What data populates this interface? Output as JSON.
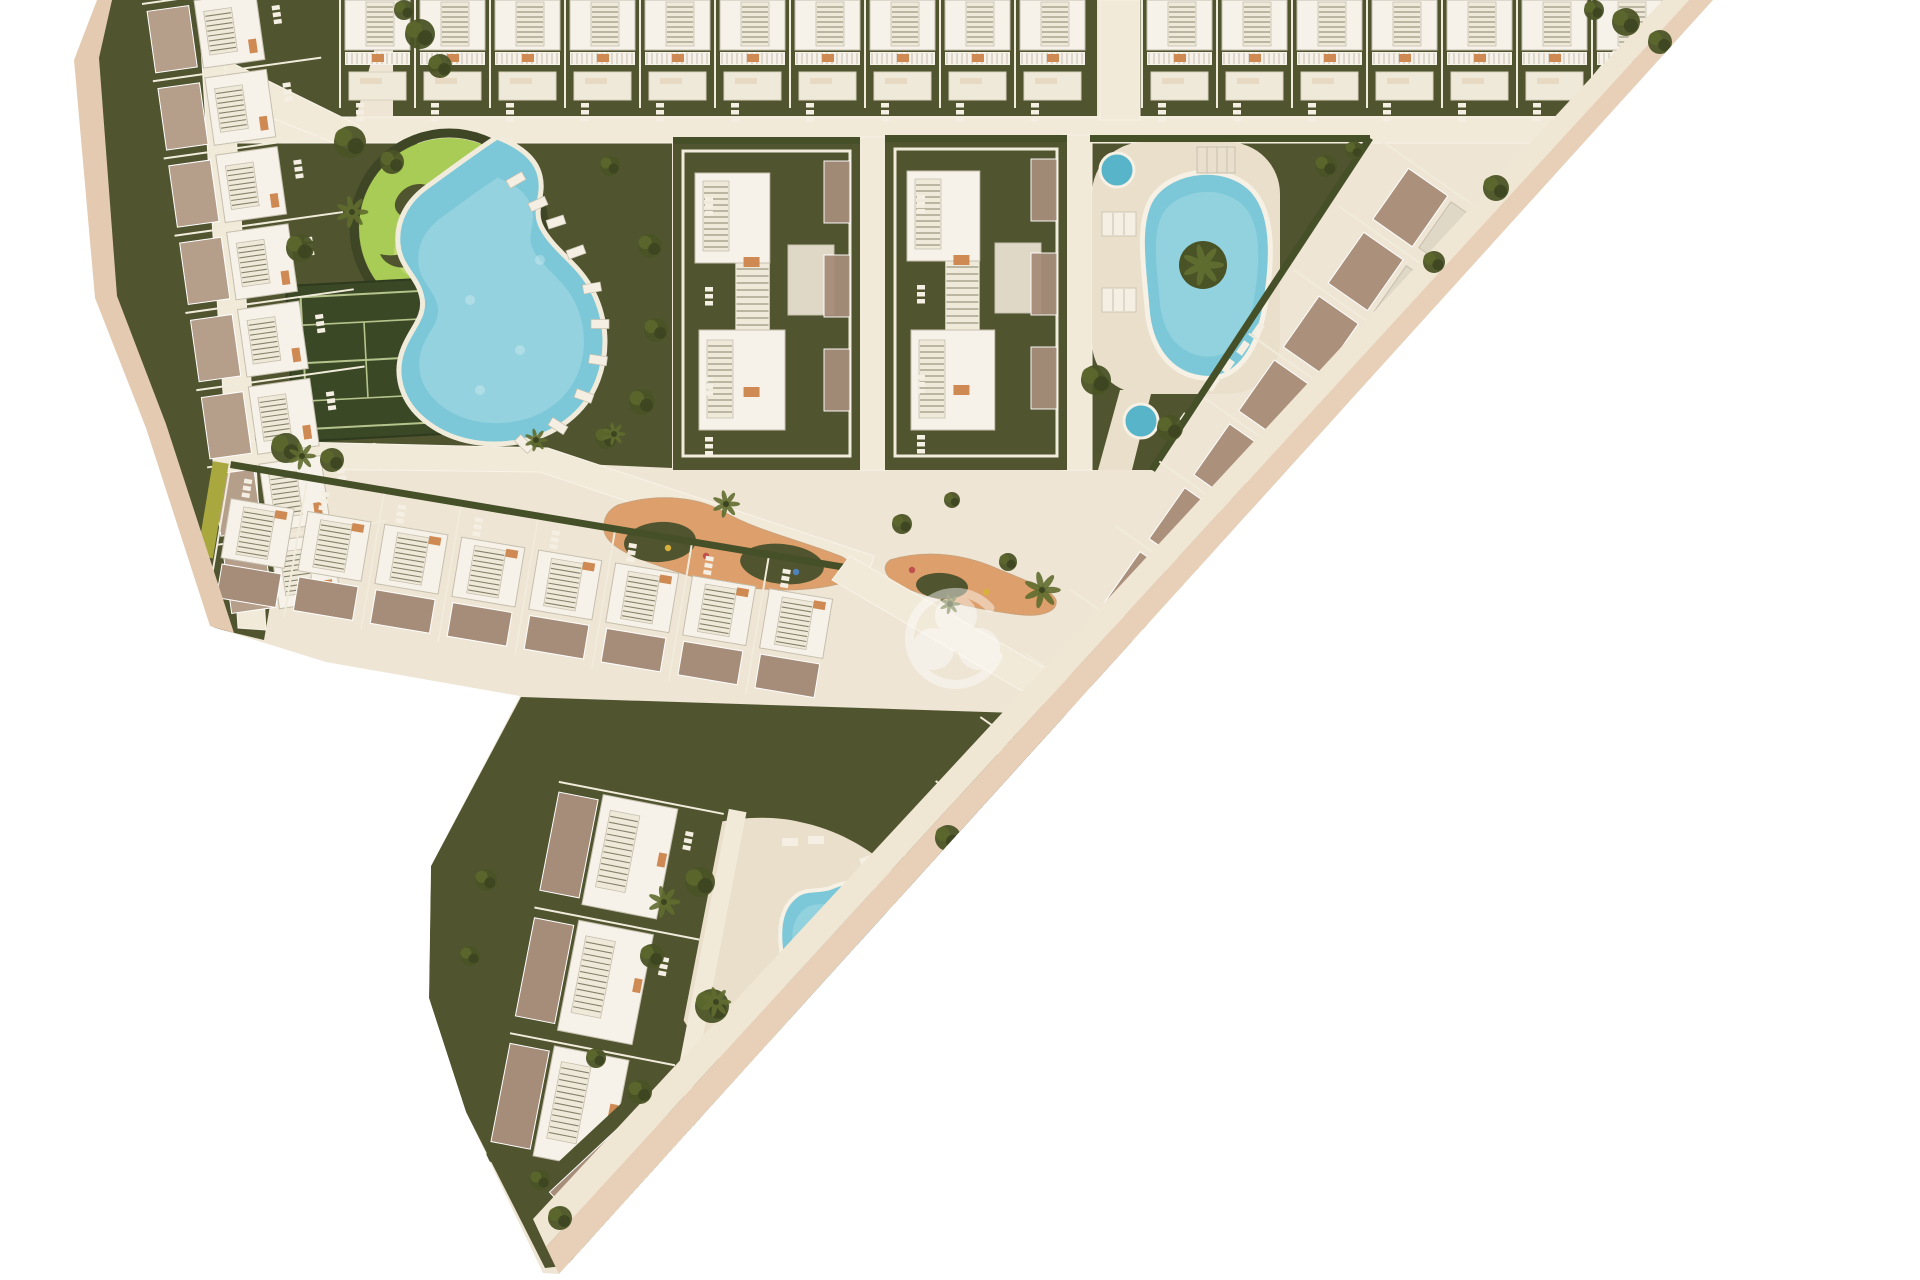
{
  "meta": {
    "type": "architectural-site-plan",
    "watermark_icon": "trefoil-logo-icon"
  },
  "colors": {
    "background": "#ffffff",
    "parcel": "#eee5d4",
    "road": "#f2ead9",
    "roadEdge": "#dfd3bd",
    "edgeOuter": "#e7cfb8",
    "edgeInner": "#f0e6d4",
    "leftBand": "#e3cab1",
    "garden": "#50542f",
    "gardenDark": "#3f4626",
    "hedge": "#454f28",
    "hedgeYellow": "#a9a83e",
    "lawn": "#a8cc55",
    "lawnLight": "#c4dc7e",
    "lawnPath": "#eae5b2",
    "court": "#3b4826",
    "courtLine": "#b6c48c",
    "water": "#7cc8d8",
    "waterLight": "#a5dbe4",
    "waterDeep": "#58b4c8",
    "deck": "#e9dfcb",
    "roofWhite": "#f6f2e9",
    "roofShade": "#e0d8c7",
    "roofEdge": "#c6bfae",
    "stairFill": "#efe9d9",
    "stairLine": "#85826b",
    "terrace": "#a68d79",
    "terraceLight": "#b59e8a",
    "accent": "#cf8a54",
    "furniture": "#f4efe2",
    "separator": "#f1ebdb",
    "tree": "#4a5326",
    "treeHi": "#5c672e",
    "treeDark": "#3c4520",
    "palm": "#5f6c2f",
    "sand": "#dd9f6b",
    "watermark": "#ffffff"
  },
  "scene": {
    "parcel": "97,0 1713,0 559,1274 543,1273 466,1112 429,998 431,866 520,696 326,662 210,626 146,428 95,298 74,60",
    "edge_bands": [
      {
        "name": "edge-band-outer-right",
        "points": "1713,0 1689,0 546,1247 559,1274",
        "color": "edgeOuter"
      },
      {
        "name": "edge-walkway-right",
        "points": "1689,0 1663,0 533,1219 546,1247",
        "color": "edgeInner"
      },
      {
        "name": "edge-band-left",
        "points": "97,0 74,60 95,298 146,428 210,626 234,633 166,424 117,296 99,58 112,0",
        "color": "leftBand"
      }
    ],
    "gardens": [
      {
        "name": "garden-top-row-west",
        "points": "393,0 1097,0 1097,116 393,116"
      },
      {
        "name": "garden-top-row-east",
        "points": "1140,0 1654,0 1560,116 1140,116"
      },
      {
        "name": "garden-left-strip",
        "points": "112,0 388,0 352,132 264,640 214,628 150,430 99,300 78,62"
      },
      {
        "name": "garden-park",
        "points": "262,133 672,133 672,468 262,450"
      },
      {
        "name": "garden-block-west",
        "points": "673,137 860,137 860,470 673,470"
      },
      {
        "name": "garden-block-east",
        "points": "885,135 1067,135 1067,470 885,470"
      },
      {
        "name": "garden-triangle",
        "points": "1090,135 1370,135 1152,470 1090,470"
      },
      {
        "name": "garden-bottom-block",
        "points": "431,866 521,697 1110,716 1135,740 563,1266 545,1268 466,1112 429,998"
      }
    ],
    "roads": [
      {
        "name": "road-top-horizontal",
        "points": "213,117 1588,117 1566,143 213,143"
      },
      {
        "name": "road-top-vertical",
        "points": "1100,0 1140,0 1140,120 1100,120"
      },
      {
        "name": "road-left-strip",
        "points": "198,0 228,0 266,630 238,628"
      },
      {
        "name": "road-park-access",
        "points": "226,60 360,126 352,150 222,98"
      },
      {
        "name": "road-mid-horizontal",
        "points": "213,440 548,448 874,556 866,582 540,472 213,468"
      },
      {
        "name": "road-between-blocks-west",
        "points": "858,137 887,137 887,470 858,470"
      },
      {
        "name": "road-between-blocks-east",
        "points": "1063,135 1092,135 1092,470 1063,470"
      }
    ],
    "roads_over": [
      {
        "name": "road-junction-diagonal",
        "points": "850,556 1124,714 1106,740 832,580"
      },
      {
        "name": "road-bottom-diagonal",
        "points": "1124,714 1148,740 579,1260 558,1238"
      }
    ],
    "park": {
      "lawn": {
        "cx": 449,
        "cy": 228,
        "r": 90
      },
      "lawn_patches": [
        [
          480,
          200,
          30
        ],
        [
          420,
          252,
          26
        ]
      ],
      "lawn_arcs": [
        "M480,158 a72,72 0 0 1 44,58",
        "M500,182 a48,48 0 0 1 26,40"
      ],
      "squiggles": [
        "M398,196 c10,-16 34,-16 40,0 c6,14 -8,26 -24,24 c-16,-2 -24,-12 -16,-24 z",
        "M438,232 c16,-6 30,2 30,16 c0,14 -16,22 -30,16 c-12,-6 -12,-26 0,-32 z",
        "M470,196 c14,-10 30,-4 32,10 c2,12 -10,22 -24,18 c-12,-4 -18,-20 -8,-28 z",
        "M420,262 c-14,10 -34,6 -40,-8 c8,2 18,2 26,-2 c6,8 10,8 14,10 z",
        "M478,250 a14,14 0 1 1 -2,26 c10,-6 8,-18 2,-26 z"
      ],
      "tennis": {
        "x": 286,
        "y": 286,
        "w": 152,
        "h": 156,
        "rotate": -3
      },
      "pool_path": "M497,137 C520,146 536,158 540,176 C545,196 532,210 542,228 C554,250 576,262 590,286 C606,314 610,348 598,380 C586,412 556,436 518,442 C482,448 448,440 424,420 C402,402 394,376 402,352 C409,330 426,318 422,298 C418,276 400,268 398,244 C396,220 408,200 428,186 C450,170 474,152 497,137 Z",
      "loungers": [
        [
          556,
          222,
          -18
        ],
        [
          576,
          252,
          -20
        ],
        [
          592,
          288,
          -10
        ],
        [
          600,
          324,
          0
        ],
        [
          598,
          360,
          8
        ],
        [
          584,
          396,
          20
        ],
        [
          558,
          426,
          32
        ],
        [
          524,
          444,
          45
        ],
        [
          516,
          180,
          -30
        ],
        [
          538,
          204,
          -24
        ]
      ]
    },
    "triangle_garden": {
      "deck": {
        "x": 1092,
        "y": 142,
        "w": 188,
        "h": 252,
        "rx": 52
      },
      "deck_tail": "1120,390 1152,390 1132,470 1098,470",
      "pool_path": "M1152,198 C1172,168 1228,162 1254,192 C1276,218 1272,268 1264,312 C1256,352 1236,382 1202,378 C1170,374 1150,348 1147,308 C1144,268 1136,224 1152,198 Z",
      "island": {
        "cx": 1203,
        "cy": 265,
        "r": 24
      },
      "round_pools": [
        [
          1117,
          170,
          17
        ],
        [
          1141,
          421,
          17
        ]
      ],
      "pergola": {
        "x": 1197,
        "y": 147,
        "w": 38,
        "h": 26
      },
      "lounger_mats": [
        [
          1102,
          212
        ],
        [
          1102,
          288
        ]
      ],
      "loungers": [
        [
          1258,
          330,
          -55
        ],
        [
          1243,
          348,
          -55
        ],
        [
          1228,
          366,
          -55
        ],
        [
          1213,
          384,
          -55
        ],
        [
          1198,
          402,
          -55
        ],
        [
          1183,
          420,
          -55
        ]
      ],
      "hedge_top": {
        "x": 1090,
        "y": 135,
        "w": 280,
        "h": 7
      },
      "hedge_diag": {
        "x1": 1370,
        "y1": 138,
        "x2": 1152,
        "y2": 470
      }
    },
    "bottom_garden": {
      "deck_path": "M668,842 C700,820 760,812 800,822 C840,830 876,852 898,876 C918,898 912,930 906,960 C900,1000 888,1034 856,1054 C824,1074 788,1082 756,1074 C722,1066 696,1044 680,1014 C664,984 654,944 656,908 C658,878 654,856 668,842 Z",
      "pool_big": "M830,888 C860,874 888,886 894,914 C900,940 884,962 890,990 C896,1020 888,1052 860,1064 C832,1076 804,1064 792,1038 C780,1012 786,982 782,956 C778,930 780,908 796,896 C806,888 818,892 830,888 Z",
      "pool_small": {
        "cx": 878,
        "cy": 933,
        "rx": 26,
        "ry": 22,
        "rotate": -20
      },
      "loungers": [
        [
          790,
          842,
          0
        ],
        [
          816,
          840,
          0
        ],
        [
          868,
          860,
          -20
        ],
        [
          900,
          886,
          -60
        ],
        [
          906,
          914,
          -70
        ],
        [
          700,
          1040,
          15
        ],
        [
          724,
          1056,
          15
        ],
        [
          756,
          1068,
          10
        ]
      ]
    },
    "playgrounds": [
      {
        "name": "playground-west",
        "blob": "M618,505 C660,492 700,498 724,512 C760,532 800,540 840,556 C856,562 854,580 838,584 C790,596 724,588 678,572 C640,560 606,548 604,530 C603,518 608,510 618,505 Z",
        "bushes": [
          [
            660,
            542,
            36,
            20,
            -4
          ],
          [
            782,
            564,
            42,
            20,
            6
          ]
        ],
        "dots": [
          [
            648,
            534,
            "#c0504d"
          ],
          [
            668,
            548,
            "#d8b13a"
          ],
          [
            706,
            556,
            "#c0504d"
          ],
          [
            796,
            572,
            "#4f81bd"
          ]
        ]
      },
      {
        "name": "playground-east",
        "blob": "M890,560 C930,548 970,556 1000,570 C1030,582 1052,590 1056,600 C1058,612 1040,618 1014,614 C970,608 920,596 898,584 C884,576 882,566 890,560 Z",
        "bushes": [
          [
            942,
            586,
            26,
            13,
            4
          ]
        ],
        "dots": [
          [
            912,
            570,
            "#c0504d"
          ],
          [
            986,
            592,
            "#d8b13a"
          ]
        ]
      }
    ],
    "mid_blocks": [
      {
        "name": "residence-block-west",
        "x": 673,
        "y": 137,
        "w": 187,
        "h": 333
      },
      {
        "name": "residence-block-east",
        "x": 885,
        "y": 135,
        "w": 182,
        "h": 335
      }
    ],
    "strips": [
      {
        "kind": "top",
        "name": "townhouse-row-top-west",
        "x": 340,
        "y": 0,
        "count": 10,
        "pitch": 75
      },
      {
        "kind": "top",
        "name": "townhouse-row-top-east",
        "x": 1142,
        "y": 0,
        "count": 7,
        "pitch": 75
      },
      {
        "kind": "left",
        "name": "townhouse-strip-left",
        "x": 142,
        "y": 4,
        "rotate": -8,
        "count": 8,
        "pitch": 78
      },
      {
        "kind": "bottomRow",
        "name": "townhouse-row-center",
        "x": 230,
        "y": 468,
        "rotate": 9.5,
        "count": 8,
        "pitch": 78
      },
      {
        "kind": "right",
        "name": "townhouse-strip-right",
        "x": 1383,
        "y": 142,
        "rotate": 125,
        "count": 12,
        "pitch": 78
      },
      {
        "kind": "column",
        "name": "townhouse-column-bottom",
        "x": 560,
        "y": 776,
        "rotate": 11,
        "count": 3,
        "pitch": 128
      },
      {
        "kind": "tip",
        "name": "townhouse-tip",
        "x": 650,
        "y": 1190,
        "rotate": 137
      }
    ],
    "trees": [
      [
        350,
        142,
        16
      ],
      [
        392,
        162,
        12
      ],
      [
        300,
        248,
        14
      ],
      [
        286,
        448,
        15
      ],
      [
        332,
        460,
        12
      ],
      [
        610,
        166,
        10
      ],
      [
        650,
        246,
        12
      ],
      [
        656,
        330,
        12
      ],
      [
        642,
        402,
        13
      ],
      [
        606,
        438,
        11
      ],
      [
        420,
        34,
        15
      ],
      [
        440,
        66,
        12
      ],
      [
        404,
        10,
        10
      ],
      [
        1626,
        22,
        14
      ],
      [
        1660,
        42,
        12
      ],
      [
        1594,
        10,
        10
      ],
      [
        1096,
        380,
        15
      ],
      [
        1170,
        428,
        13
      ],
      [
        1326,
        166,
        11
      ],
      [
        1354,
        150,
        9
      ],
      [
        1496,
        188,
        13
      ],
      [
        1434,
        262,
        11
      ],
      [
        1210,
        632,
        11
      ],
      [
        1282,
        550,
        10
      ],
      [
        902,
        524,
        10
      ],
      [
        1008,
        562,
        9
      ],
      [
        952,
        500,
        8
      ],
      [
        700,
        882,
        15
      ],
      [
        712,
        1006,
        17
      ],
      [
        880,
        1032,
        15
      ],
      [
        948,
        838,
        13
      ],
      [
        760,
        1108,
        13
      ],
      [
        802,
        1122,
        11
      ],
      [
        862,
        1064,
        12
      ],
      [
        652,
        956,
        12
      ],
      [
        560,
        1218,
        12
      ],
      [
        540,
        1180,
        10
      ],
      [
        640,
        1092,
        12
      ],
      [
        596,
        1058,
        10
      ],
      [
        486,
        880,
        11
      ],
      [
        470,
        956,
        10
      ],
      [
        1060,
        800,
        11
      ],
      [
        1000,
        856,
        10
      ]
    ],
    "palms": [
      [
        352,
        212,
        14
      ],
      [
        302,
        456,
        12
      ],
      [
        726,
        504,
        12
      ],
      [
        1042,
        590,
        16
      ],
      [
        664,
        902,
        14
      ],
      [
        716,
        1002,
        13
      ],
      [
        884,
        1028,
        13
      ],
      [
        950,
        604,
        9
      ],
      [
        536,
        440,
        10
      ],
      [
        614,
        434,
        10
      ]
    ],
    "watermark": {
      "cx": 956,
      "cy": 640,
      "opacity": 0.45
    }
  }
}
